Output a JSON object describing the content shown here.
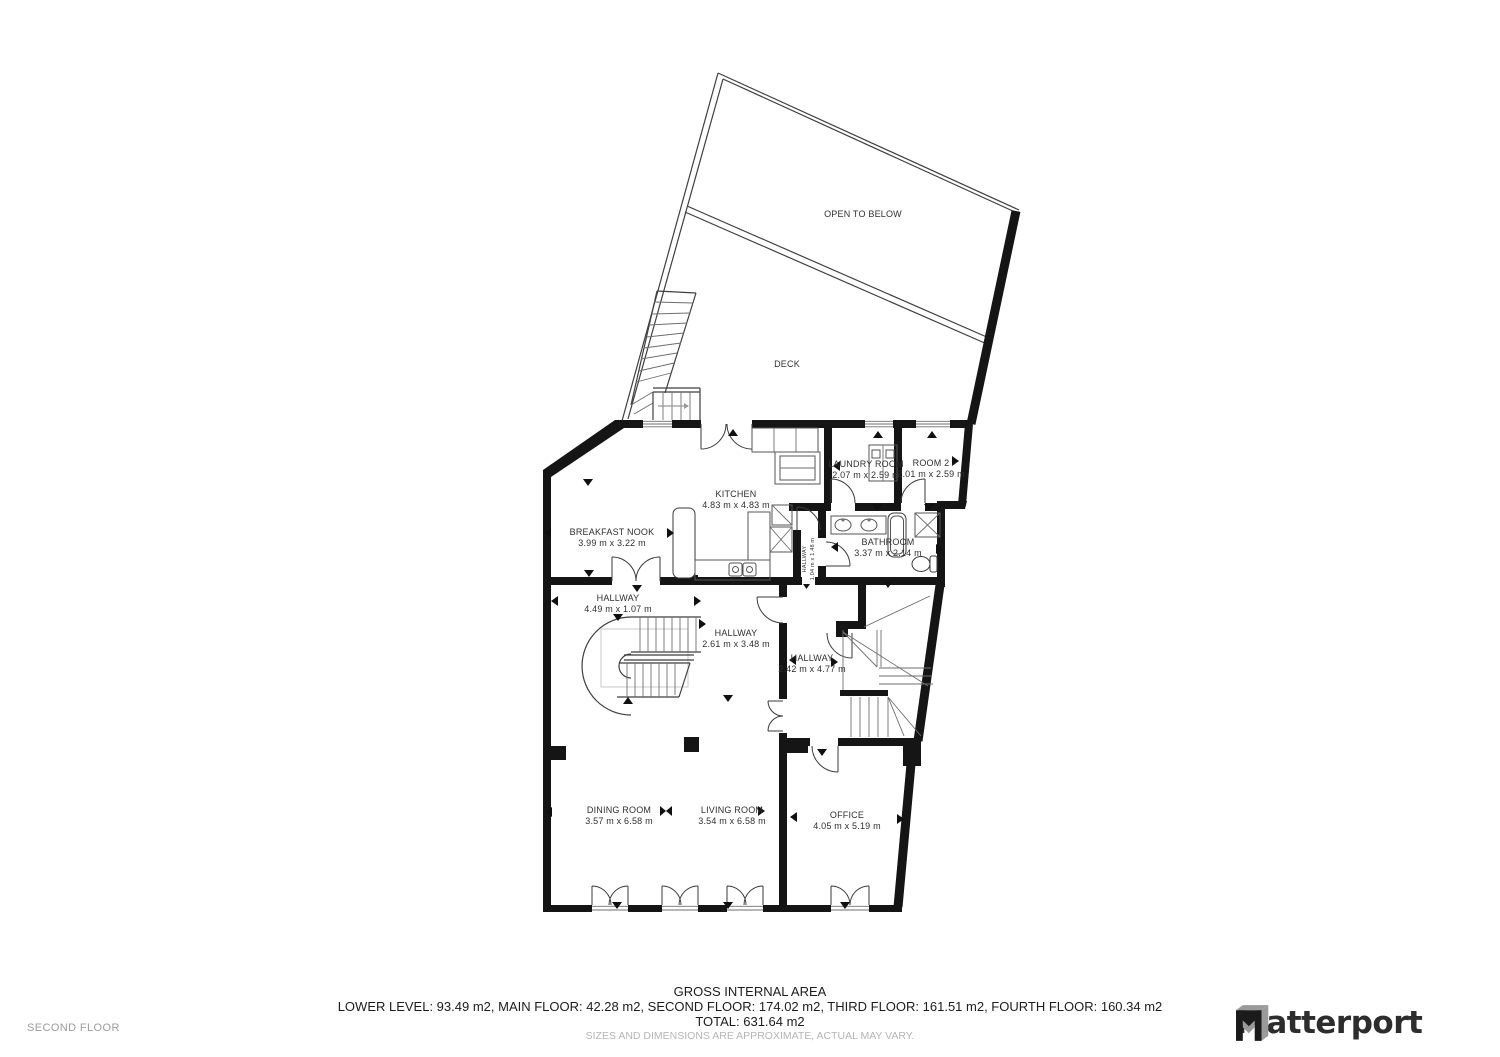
{
  "page": {
    "floor_label": "SECOND FLOOR"
  },
  "brand": {
    "wordmark": "Matterport"
  },
  "footer": {
    "title": "GROSS INTERNAL AREA",
    "breakdown": "LOWER LEVEL: 93.49 m2, MAIN FLOOR: 42.28 m2, SECOND FLOOR: 174.02 m2, THIRD FLOOR: 161.51 m2, FOURTH FLOOR: 160.34 m2",
    "total": "TOTAL: 631.64 m2",
    "disclaimer": "SIZES AND DIMENSIONS ARE APPROXIMATE, ACTUAL MAY VARY."
  },
  "rooms": [
    {
      "label": "OPEN TO BELOW",
      "dims": ""
    },
    {
      "label": "DECK",
      "dims": ""
    },
    {
      "label": "KITCHEN",
      "dims": "4.83 m x 4.83 m"
    },
    {
      "label": "BREAKFAST NOOK",
      "dims": "3.99 m x 3.22 m"
    },
    {
      "label": "LAUNDRY ROOM",
      "dims": "2.07 m x 2.59 m"
    },
    {
      "label": "ROOM 2",
      "dims": "2.01 m x 2.59 m"
    },
    {
      "label": "BATHROOM",
      "dims": "3.37 m x 2.14 m"
    },
    {
      "label": "HALLWAY",
      "dims": "4.49 m x 1.07 m"
    },
    {
      "label": "HALLWAY",
      "dims": "2.61 m x 3.48 m"
    },
    {
      "label": "HALLWAY",
      "dims": "2.42 m x 4.77 m"
    },
    {
      "label": "HALLWAY",
      "dims": "1.04 m x 1.48 m"
    },
    {
      "label": "DINING ROOM",
      "dims": "3.57 m x 6.58 m"
    },
    {
      "label": "LIVING ROOM",
      "dims": "3.54 m x 6.58 m"
    },
    {
      "label": "OFFICE",
      "dims": "4.05 m x 5.19 m"
    }
  ]
}
